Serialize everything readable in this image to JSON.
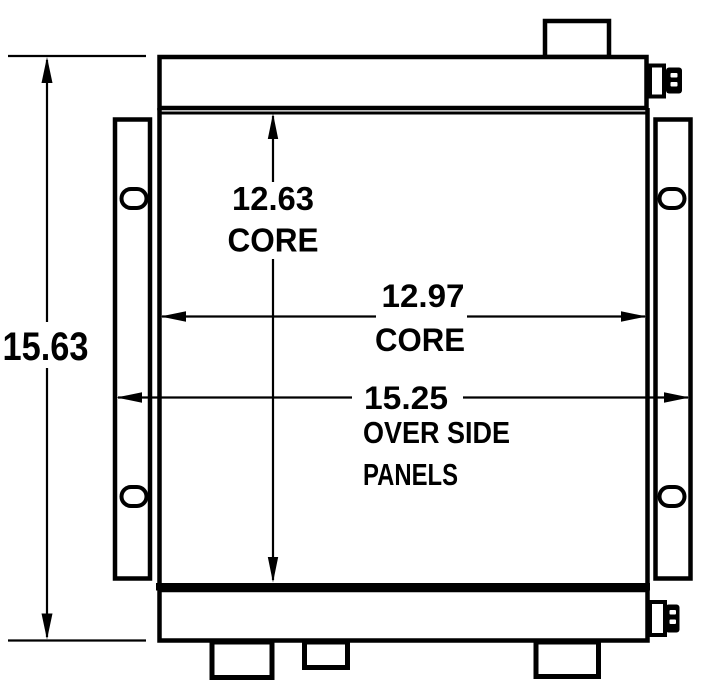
{
  "colors": {
    "line": "#000000",
    "background": "#ffffff"
  },
  "dimensions": {
    "overall_height": "15.63",
    "core_height": "12.63",
    "core_height_label": "CORE",
    "core_width": "12.97",
    "core_width_label": "CORE",
    "over_side_panels": "15.25",
    "over_side_panels_label_line1": "OVER SIDE",
    "over_side_panels_label_line2": "PANELS"
  }
}
